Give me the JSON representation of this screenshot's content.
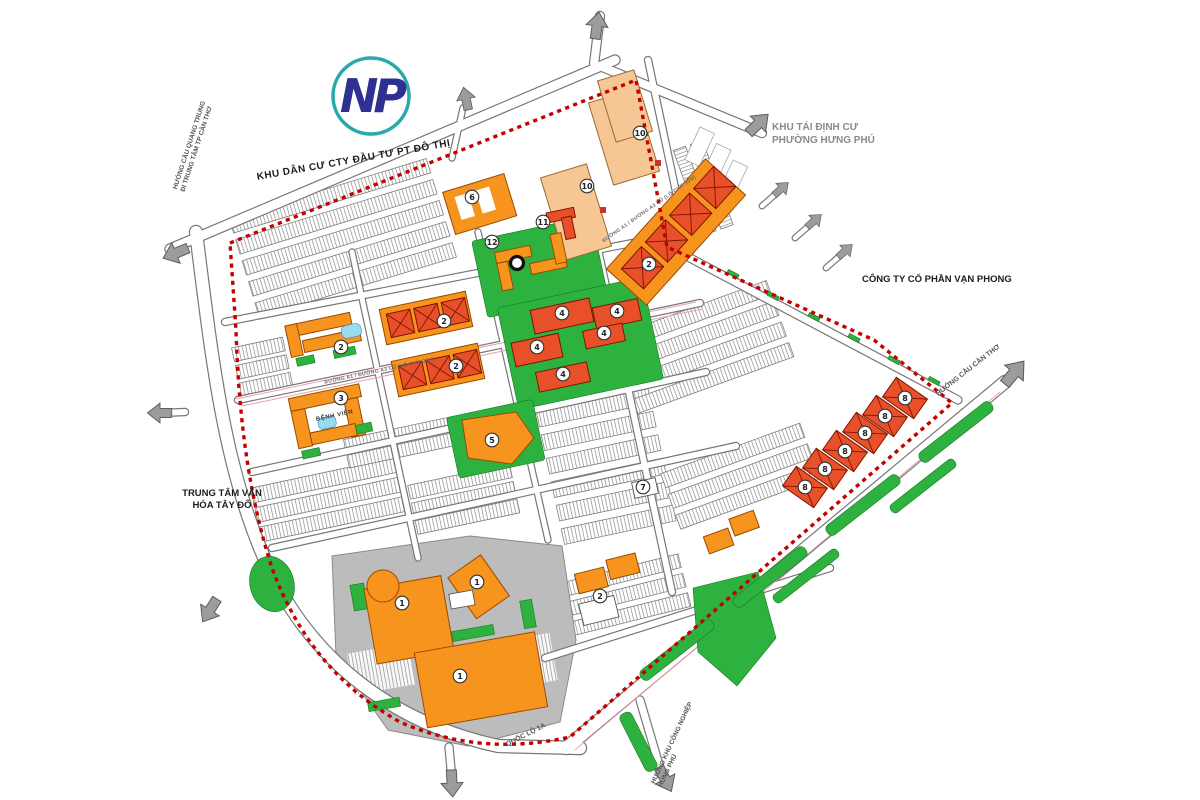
{
  "map": {
    "logo": {
      "text": "NP"
    },
    "labels": {
      "top_road": "KHU DÂN CƯ CTY ĐẦU TƯ PT ĐÔ THỊ",
      "resettlement": {
        "line1": "KHU TÁI ĐỊNH CƯ",
        "line2": "PHƯỜNG HƯNG PHÚ"
      },
      "company": "CÔNG TY CỔ PHẦN VẠN PHONG",
      "culture_center": {
        "line1": "TRUNG TÂM VĂN",
        "line2": "HÓA TÂY ĐÔ"
      },
      "dir_quang_trung": {
        "line1": "HƯỚNG CẦU QUANG TRUNG",
        "line2": "ĐI TRUNG TÂM TP CẦN THƠ"
      },
      "dir_can_tho": "HƯỚNG CẦU CẦN THƠ",
      "dir_industrial": {
        "line1": "HƯỚNG KHU CÔNG NGHIỆP",
        "line2": "HƯNG PHÚ"
      },
      "highway": "QUỐC LỘ 1A",
      "hospital": "BỆNH VIỆN",
      "road_center": "ĐƯỜNG A1 / ĐƯỜNG A3 CŨ (LỘ GIỚI 30M)"
    },
    "colors": {
      "boundary_red": "#C40000",
      "orange": "#F7941E",
      "red_orange": "#E8502A",
      "peach": "#F6C794",
      "green": "#2DB240",
      "road_gray": "#777777",
      "logo_blue": "#2E3192",
      "logo_teal": "#2AA9AD"
    },
    "parcel_markers": [
      {
        "num": "1",
        "x": 402,
        "y": 603
      },
      {
        "num": "1",
        "x": 460,
        "y": 676
      },
      {
        "num": "1",
        "x": 477,
        "y": 582
      },
      {
        "num": "2",
        "x": 341,
        "y": 347
      },
      {
        "num": "2",
        "x": 444,
        "y": 321
      },
      {
        "num": "2",
        "x": 456,
        "y": 366
      },
      {
        "num": "2",
        "x": 649,
        "y": 264
      },
      {
        "num": "2",
        "x": 600,
        "y": 596
      },
      {
        "num": "3",
        "x": 341,
        "y": 398
      },
      {
        "num": "4",
        "x": 562,
        "y": 313
      },
      {
        "num": "4",
        "x": 617,
        "y": 311
      },
      {
        "num": "4",
        "x": 604,
        "y": 333
      },
      {
        "num": "4",
        "x": 537,
        "y": 347
      },
      {
        "num": "4",
        "x": 563,
        "y": 374
      },
      {
        "num": "5",
        "x": 492,
        "y": 440
      },
      {
        "num": "6",
        "x": 472,
        "y": 197
      },
      {
        "num": "7",
        "x": 643,
        "y": 487
      },
      {
        "num": "8",
        "x": 805,
        "y": 487
      },
      {
        "num": "8",
        "x": 825,
        "y": 469
      },
      {
        "num": "8",
        "x": 845,
        "y": 451
      },
      {
        "num": "8",
        "x": 865,
        "y": 433
      },
      {
        "num": "8",
        "x": 885,
        "y": 416
      },
      {
        "num": "8",
        "x": 905,
        "y": 398
      },
      {
        "num": "10",
        "x": 640,
        "y": 133
      },
      {
        "num": "10",
        "x": 587,
        "y": 186
      },
      {
        "num": "11",
        "x": 543,
        "y": 222
      },
      {
        "num": "12",
        "x": 492,
        "y": 242
      }
    ],
    "exit_arrows": [
      {
        "x": 597,
        "y": 26,
        "rot": 8,
        "s": 1
      },
      {
        "x": 466,
        "y": 99,
        "rot": -12,
        "s": 0.85
      },
      {
        "x": 758,
        "y": 124,
        "rot": 46,
        "s": 1
      },
      {
        "x": 781,
        "y": 189,
        "rot": 48,
        "s": 0.7
      },
      {
        "x": 814,
        "y": 221,
        "rot": 48,
        "s": 0.7
      },
      {
        "x": 845,
        "y": 251,
        "rot": 48,
        "s": 0.7
      },
      {
        "x": 176,
        "y": 253,
        "rot": -112,
        "s": 1
      },
      {
        "x": 160,
        "y": 413,
        "rot": -90,
        "s": 0.9
      },
      {
        "x": 210,
        "y": 610,
        "rot": -148,
        "s": 1
      },
      {
        "x": 452,
        "y": 783,
        "rot": 177,
        "s": 1
      },
      {
        "x": 665,
        "y": 779,
        "rot": 153,
        "s": 1
      },
      {
        "x": 1014,
        "y": 373,
        "rot": 40,
        "s": 1.1
      }
    ]
  }
}
